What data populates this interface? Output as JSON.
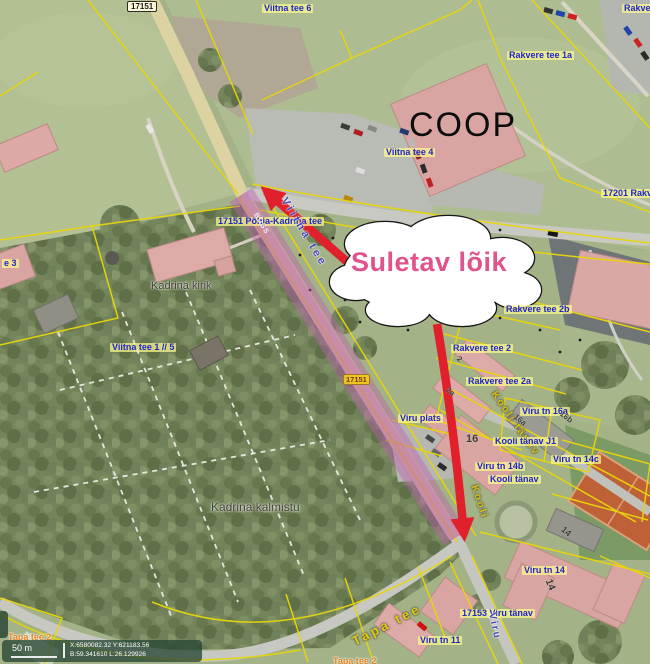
{
  "colors": {
    "closure_highlight": "#c25eb5",
    "arrow_red": "#e0202a",
    "callout_text_pink": "#e0538c",
    "cadastral_line_yellow": "#e8d60a",
    "address_label_blue": "#2026c8"
  },
  "annotation": {
    "callout_text": "Suletav lõik"
  },
  "poi": {
    "store": "COOP"
  },
  "badges": {
    "road_17151_top": "17151",
    "road_17151_mid": "17151"
  },
  "labels": {
    "viitna_tee_6": "Viitna tee 6",
    "rakver_top_right": "Rakver",
    "rakvere_tee_1a": "Rakvere tee 1a",
    "viitna_tee_4": "Viitna tee 4",
    "r17201_rakvere": "17201 Rakv",
    "pohja_kadrina_tee": "17151 Põhja-Kadrina tee",
    "viitna_tee_street": "Viitna tee",
    "buss_marking": "BUSS",
    "kadrina_kirik": "Kadrina kirik",
    "viitna_tee_3_partial": "e 3",
    "viitna_tee_1_5": "Viitna tee 1 // 5",
    "kadrina_kalmistu": "Kadrina kalmistu",
    "rakvere_tee_2b": "Rakvere tee 2b",
    "rakvere_tee_2": "Rakvere tee 2",
    "rakvere_tee_2a": "Rakvere tee 2a",
    "viru_plats": "Viru plats",
    "viru_tn_16a": "Viru tn 16a",
    "kooli_tanav_j1": "Kooli tänav J1",
    "viru_tn_14b": "Viru tn 14b",
    "kooli_tanav_blue": "Kooli tänav",
    "viru_tn_14c": "Viru tn 14c",
    "kooli_tanav_street": "Kooli tänav",
    "kooli_street_stub": "Kooli",
    "viru_tn_14": "Viru tn 14",
    "viru_tanav_17153": "17153 Viru tänav",
    "viru_tn_11": "Viru tn 11",
    "viru_street": "Viru",
    "tapa_tee_street": "Tapa tee",
    "tapa_tee_2": "Tapa tee 2",
    "tapa_tee_2_partial": "Tapa tee 2"
  },
  "house_numbers": {
    "n2": "2",
    "n2a": "2a",
    "n16": "16",
    "n16a": "16a",
    "n16b": "16b",
    "n14_gray": "14",
    "n14_school": "14"
  },
  "statusbar": {
    "scale_label": "50 m",
    "coords_xy": "X:6580082.32 Y:621183.56",
    "coords_bl": "B:59.341610 L:26.129926"
  }
}
